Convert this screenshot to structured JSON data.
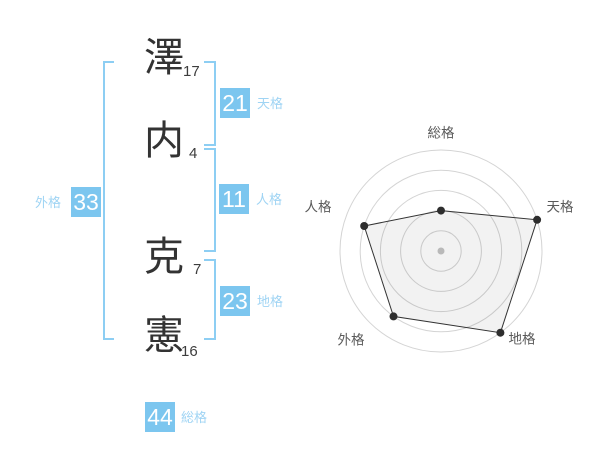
{
  "panel": {
    "surname": [
      {
        "char": "澤",
        "strokes": "17"
      },
      {
        "char": "内",
        "strokes": "4"
      }
    ],
    "given_name": [
      {
        "char": "克",
        "strokes": "7"
      },
      {
        "char": "憲",
        "strokes": "16"
      }
    ],
    "scores": {
      "tenkaku": {
        "value": "21",
        "label": "天格"
      },
      "jinkaku": {
        "value": "11",
        "label": "人格"
      },
      "chikaku": {
        "value": "23",
        "label": "地格"
      },
      "gaikaku": {
        "value": "33",
        "label": "外格"
      },
      "soukaku": {
        "value": "44",
        "label": "総格"
      }
    }
  },
  "colors": {
    "accent_blue": "#7cc6ef",
    "label_blue": "#9fd4f4",
    "bracket_blue": "#8dcef3",
    "chip_text": "#ffffff",
    "kanji_color": "#333333",
    "ring_gray": "#d4d4d4",
    "plot_line": "#333333",
    "plot_fill": "rgba(0,0,0,0.05)",
    "vertex_dot": "#2e2e2e",
    "center_dot": "#b9b9b9",
    "axis_label_gray": "#5a5a5a"
  },
  "chart_data": {
    "type": "radar",
    "axes": [
      {
        "label": "総格",
        "value": 40
      },
      {
        "label": "天格",
        "value": 100
      },
      {
        "label": "地格",
        "value": 100
      },
      {
        "label": "外格",
        "value": 80
      },
      {
        "label": "人格",
        "value": 80
      }
    ],
    "scale": {
      "min": 0,
      "max": 100,
      "rings": 5
    },
    "grid": "concentric-circles",
    "legend": false,
    "title": ""
  }
}
